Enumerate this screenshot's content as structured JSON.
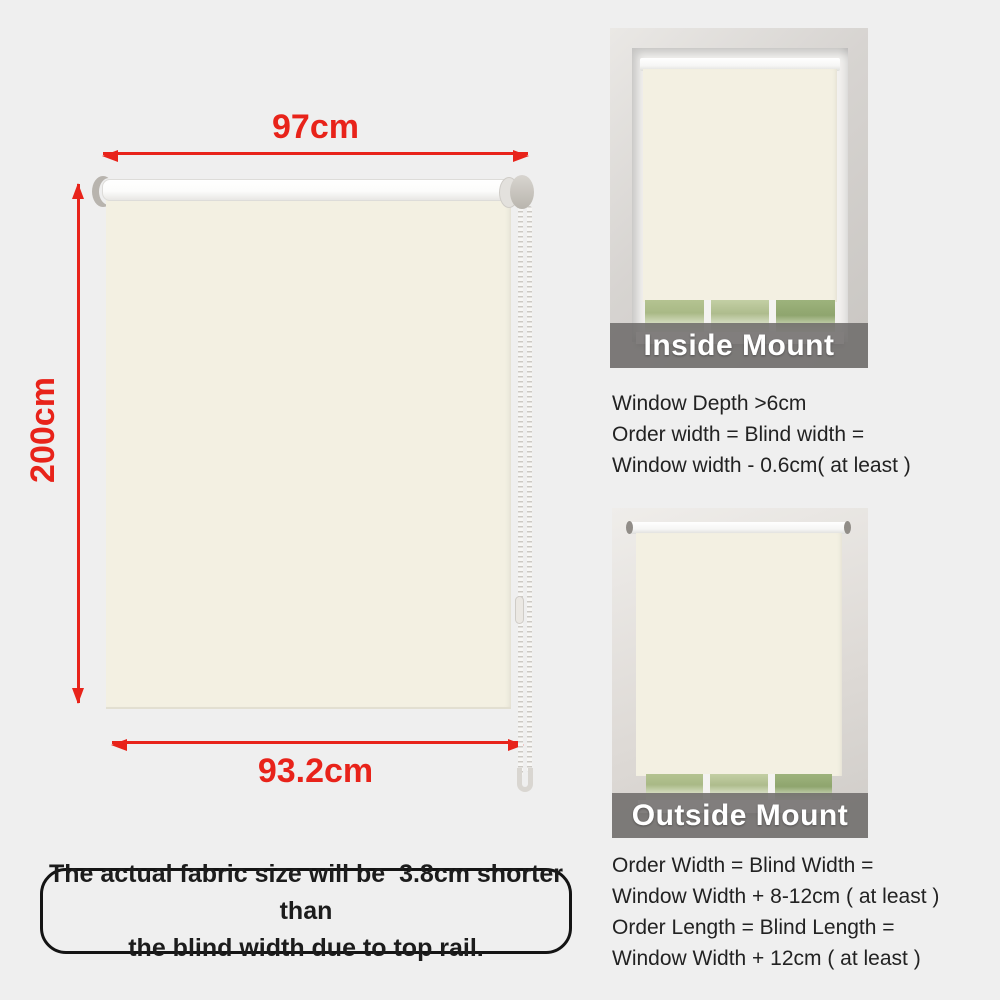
{
  "colors": {
    "accent_red": "#e8231a",
    "fabric_cream": "#f3f0e2",
    "page_background": "#efefef",
    "banner_gray": "rgba(108,106,104,0.85)",
    "banner_text": "#ffffff",
    "body_text": "#1c1c1c"
  },
  "diagram": {
    "blind_width_label": "97cm",
    "blind_height_label": "200cm",
    "fabric_width_label": "93.2cm"
  },
  "note": {
    "line1": "The actual fabric size will be  3.8cm shorter than",
    "line2": "the blind width due to top rail."
  },
  "inside_mount": {
    "title": "Inside Mount",
    "lines": [
      "Window Depth >6cm",
      "Order width = Blind width =",
      "Window width - 0.6cm( at least )"
    ]
  },
  "outside_mount": {
    "title": "Outside Mount",
    "lines": [
      "Order Width = Blind Width =",
      "Window Width + 8-12cm ( at least )",
      "Order Length = Blind Length =",
      "Window Width + 12cm ( at least )"
    ]
  }
}
